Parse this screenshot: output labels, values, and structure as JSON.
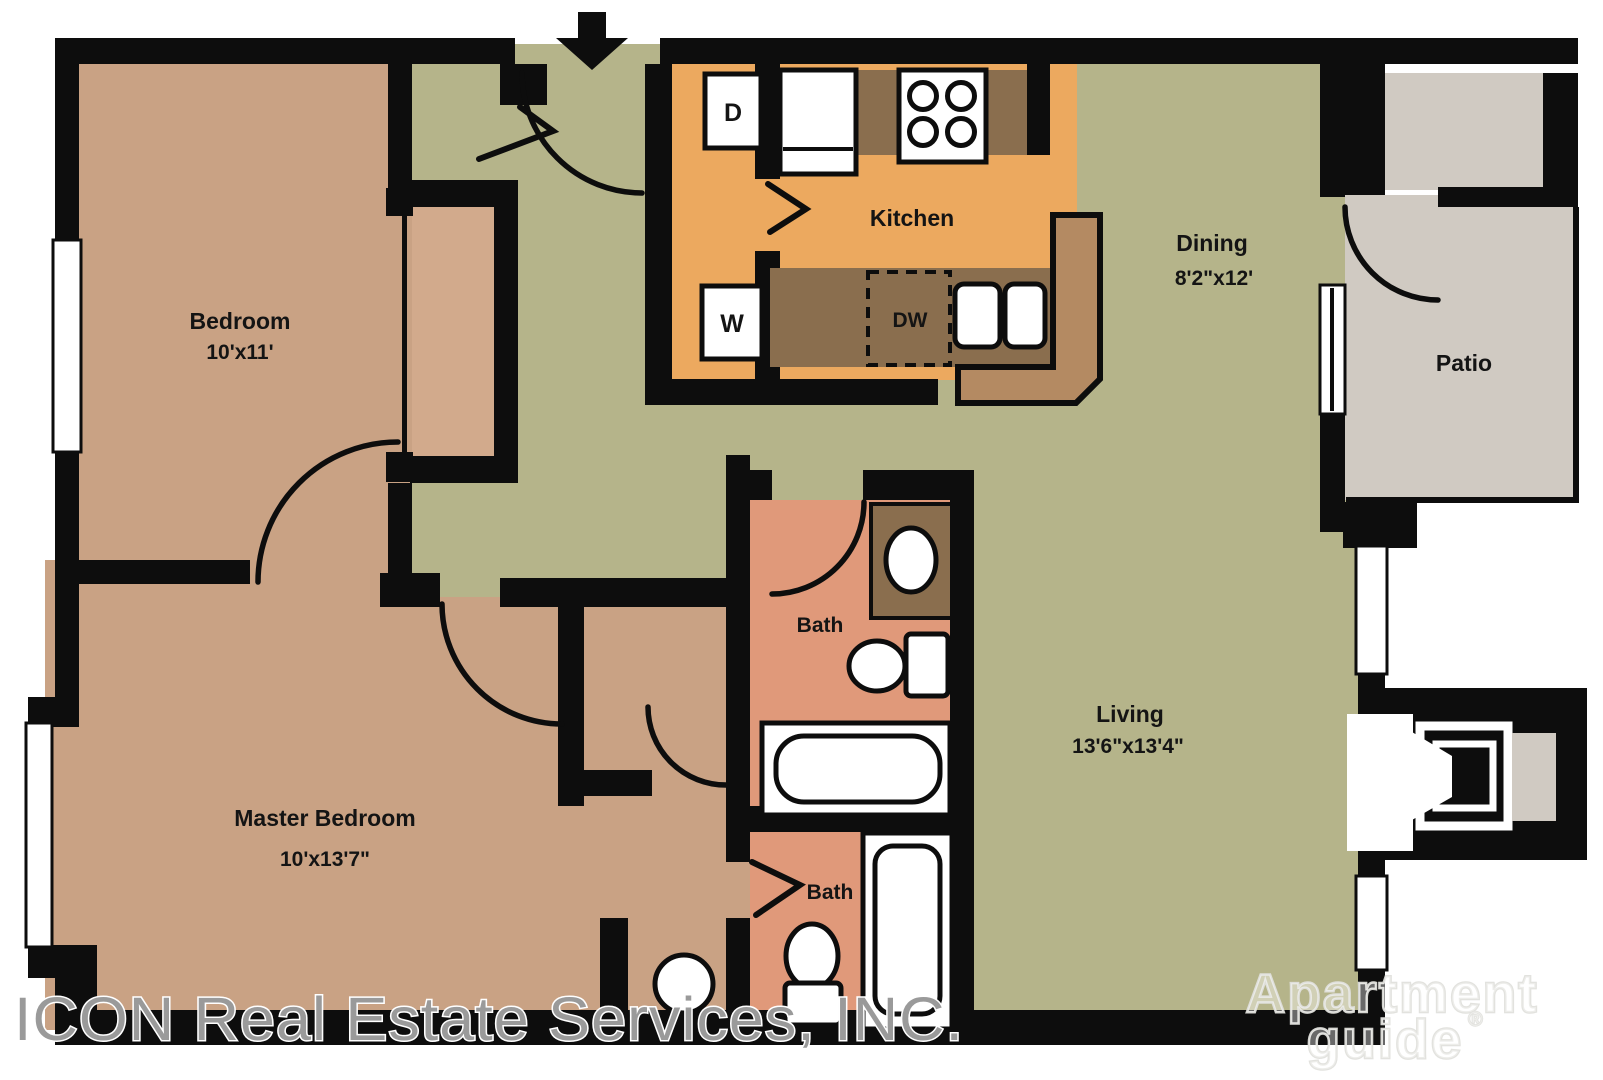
{
  "plan": {
    "rooms": {
      "bedroom": {
        "name": "Bedroom",
        "dims": "10'x11'"
      },
      "master_bedroom": {
        "name": "Master Bedroom",
        "dims": "10'x13'7\""
      },
      "kitchen": {
        "name": "Kitchen"
      },
      "dining": {
        "name": "Dining",
        "dims": "8'2\"x12'"
      },
      "living": {
        "name": "Living",
        "dims": "13'6\"x13'4\""
      },
      "patio": {
        "name": "Patio"
      },
      "bath_upper": {
        "name": "Bath"
      },
      "bath_lower": {
        "name": "Bath"
      }
    },
    "appliances": {
      "dryer": "D",
      "washer": "W",
      "dishwasher": "DW"
    }
  },
  "watermarks": {
    "company": "ICON Real Estate Services, INC.",
    "brand_line1": "Apartment",
    "brand_line2": "guide",
    "registered_mark": "®"
  },
  "colors": {
    "wall": "#0d0d0d",
    "floor_tan": "#c9a284",
    "floor_tan_light": "#d2aa8c",
    "floor_olive": "#b5b48a",
    "floor_orange": "#eca95f",
    "counter_light": "#b48a62",
    "counter_dark": "#8a6e4e",
    "floor_salmon": "#e0997a",
    "floor_gray": "#d0cac2",
    "fixture_white": "#ffffff",
    "label_text": "#141414",
    "watermark_gray": "#9a9a9a"
  }
}
